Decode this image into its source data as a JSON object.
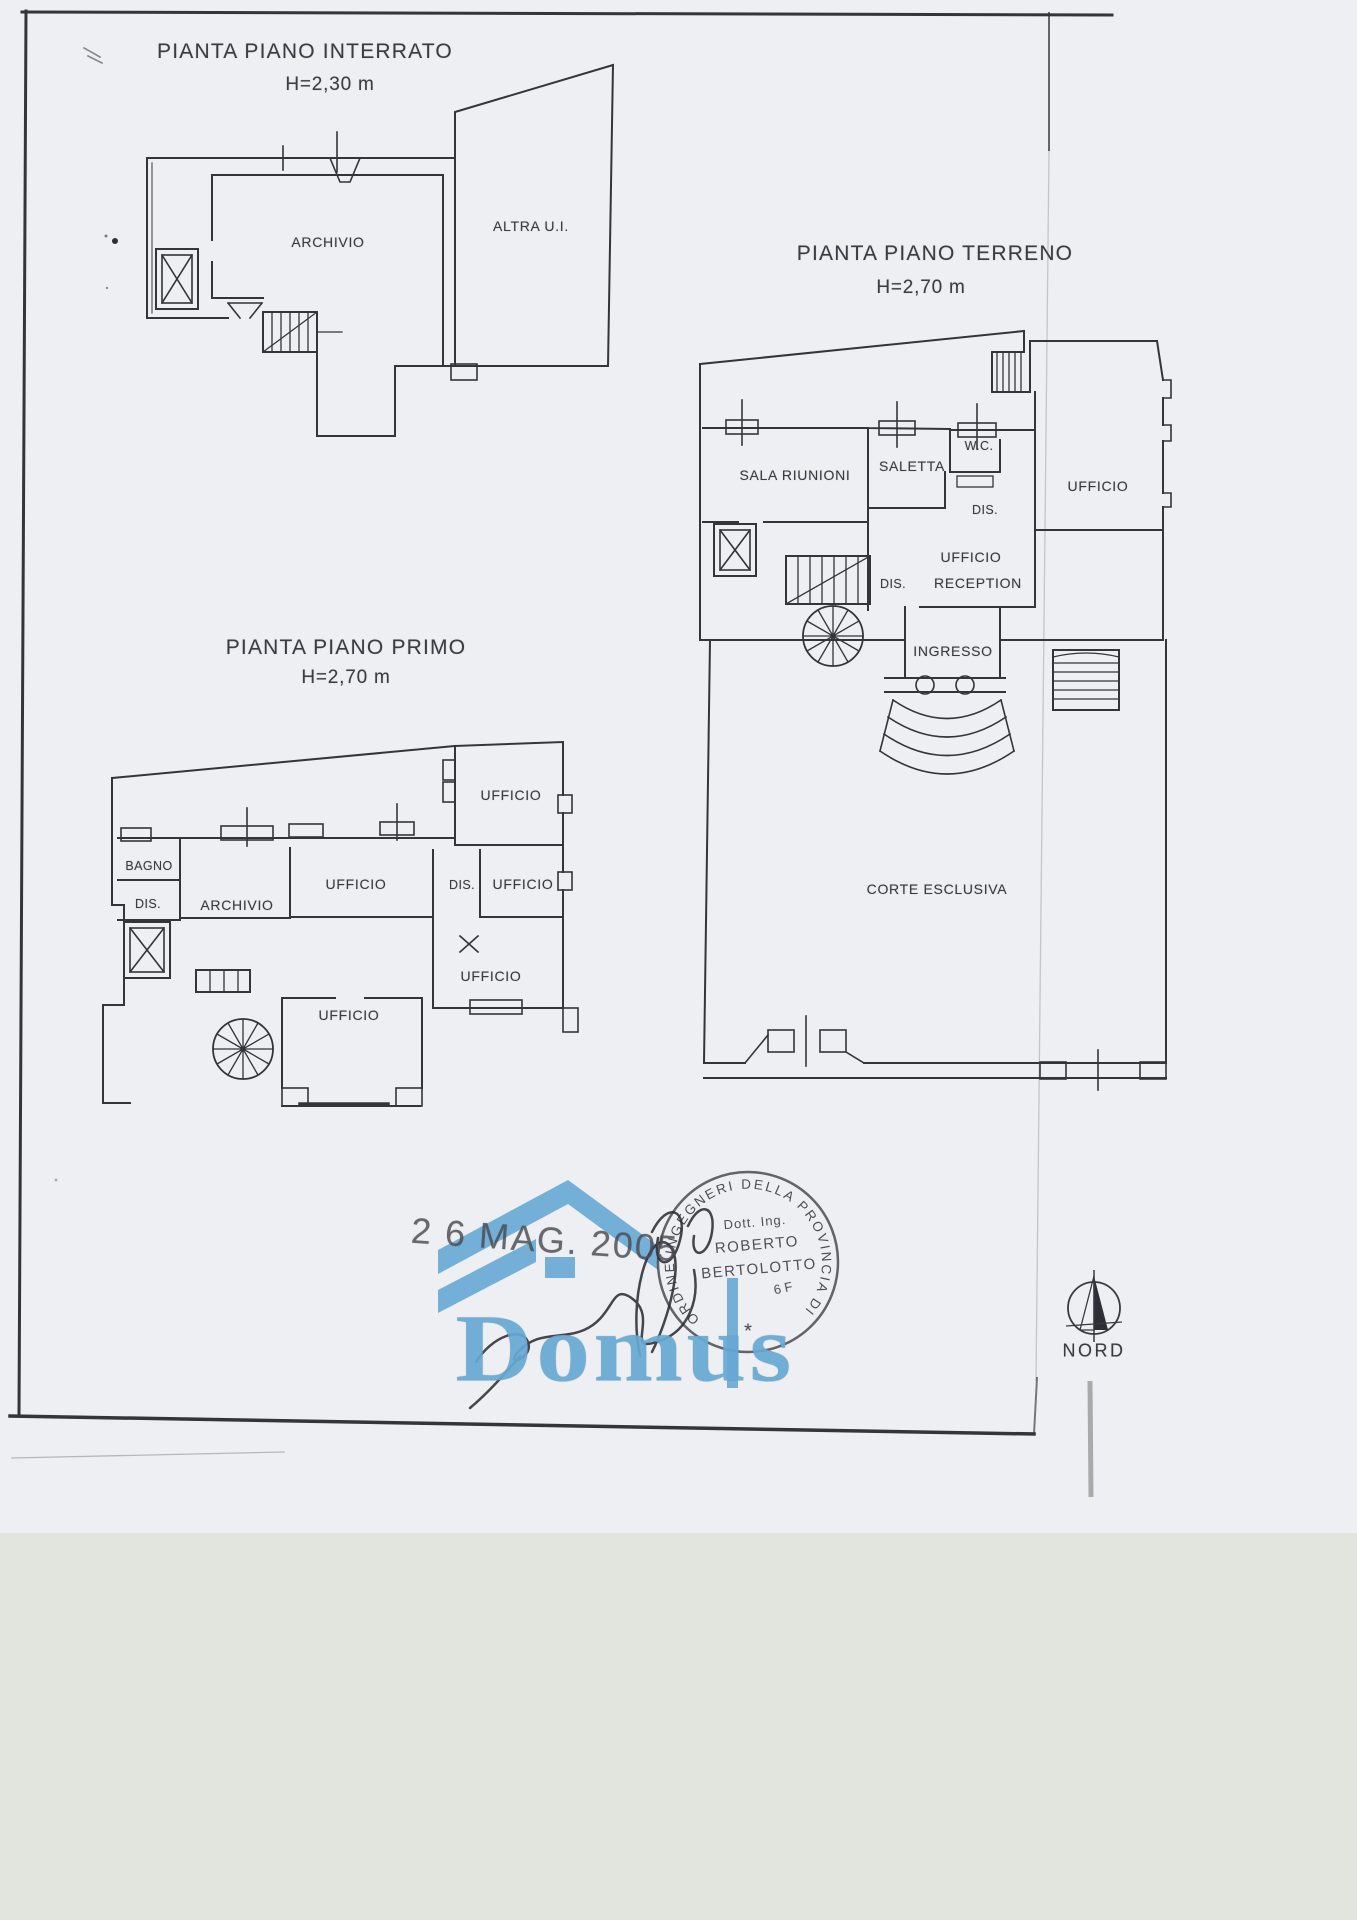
{
  "plans": {
    "interrato": {
      "title": "PIANTA PIANO INTERRATO",
      "height": "H=2,30 m",
      "rooms": {
        "archivio": "ARCHIVIO",
        "altra_ui": "ALTRA U.I."
      }
    },
    "terreno": {
      "title": "PIANTA PIANO TERRENO",
      "height": "H=2,70 m",
      "rooms": {
        "sala_riunioni": "SALA RIUNIONI",
        "saletta": "SALETTA",
        "wc": "W.C.",
        "dis1": "DIS.",
        "ufficio_right": "UFFICIO",
        "ufficio_rec1": "UFFICIO",
        "ufficio_rec2": "RECEPTION",
        "dis2": "DIS.",
        "ingresso": "INGRESSO",
        "corte": "CORTE ESCLUSIVA"
      }
    },
    "primo": {
      "title": "PIANTA PIANO PRIMO",
      "height": "H=2,70 m",
      "rooms": {
        "ufficio_top": "UFFICIO",
        "bagno": "BAGNO",
        "dis1": "DIS.",
        "archivio": "ARCHIVIO",
        "ufficio_center": "UFFICIO",
        "dis2": "DIS.",
        "ufficio_right": "UFFICIO",
        "ufficio_mid_right": "UFFICIO",
        "ufficio_bottom": "UFFICIO"
      }
    }
  },
  "stamps": {
    "date": "2 6 MAG. 2005",
    "ring": "ORDINE INGEGNERI DELLA PROVINCIA DI TORINO",
    "star": "*",
    "line1": "Dott. Ing.",
    "line2": "ROBERTO",
    "line3": "BERTOLOTTO",
    "number_fragment": "6 F"
  },
  "watermark": {
    "brand": "Domus"
  },
  "compass": {
    "label": "NORD"
  },
  "colors": {
    "brand_blue": "#66a9d4",
    "ink": "#34343b",
    "paper": "#edeff3",
    "scanner_band": "#e2e4de"
  }
}
